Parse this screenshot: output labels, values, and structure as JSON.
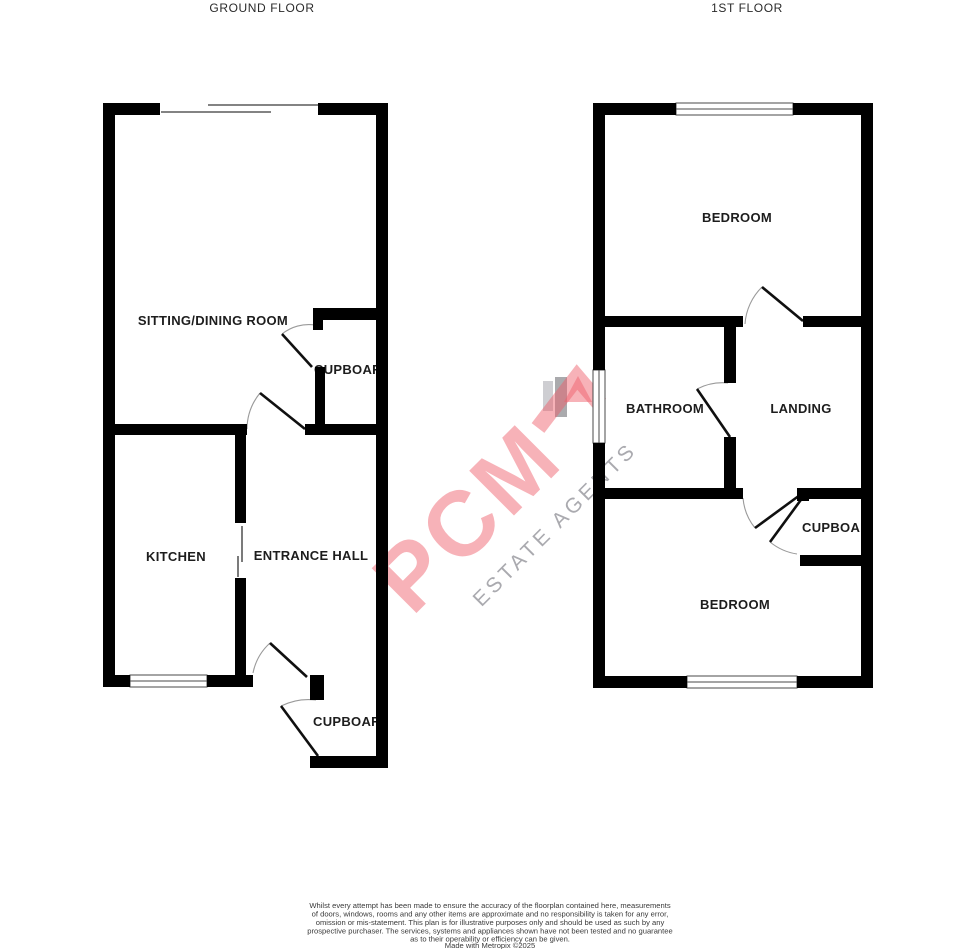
{
  "floors": [
    {
      "title": "GROUND FLOOR",
      "rooms": [
        {
          "label": "SITTING/DINING ROOM"
        },
        {
          "label": "CUPBOARD"
        },
        {
          "label": "KITCHEN"
        },
        {
          "label": "ENTRANCE HALL"
        },
        {
          "label": "CUPBOARD"
        }
      ]
    },
    {
      "title": "1ST FLOOR",
      "rooms": [
        {
          "label": "BEDROOM"
        },
        {
          "label": "BATHROOM"
        },
        {
          "label": "LANDING"
        },
        {
          "label": "CUPBOARD"
        },
        {
          "label": "BEDROOM"
        }
      ]
    }
  ],
  "watermark": {
    "brand": "PCM",
    "tagline": "ESTATE AGENTS",
    "brand_color": "#ee5f6b",
    "tagline_color": "#8e8e94"
  },
  "footer": {
    "lines": [
      "Whilst every attempt has been made to ensure the accuracy of the floorplan contained here, measurements",
      "of doors, windows, rooms and any other items are approximate and no responsibility is taken for any error,",
      "omission or mis-statement. This plan is for illustrative purposes only and should be used as such by any",
      "prospective purchaser. The services, systems and appliances shown have not been tested and no guarantee",
      "as to their operability or efficiency can be given.",
      "Made with Metropix ©2025"
    ]
  }
}
